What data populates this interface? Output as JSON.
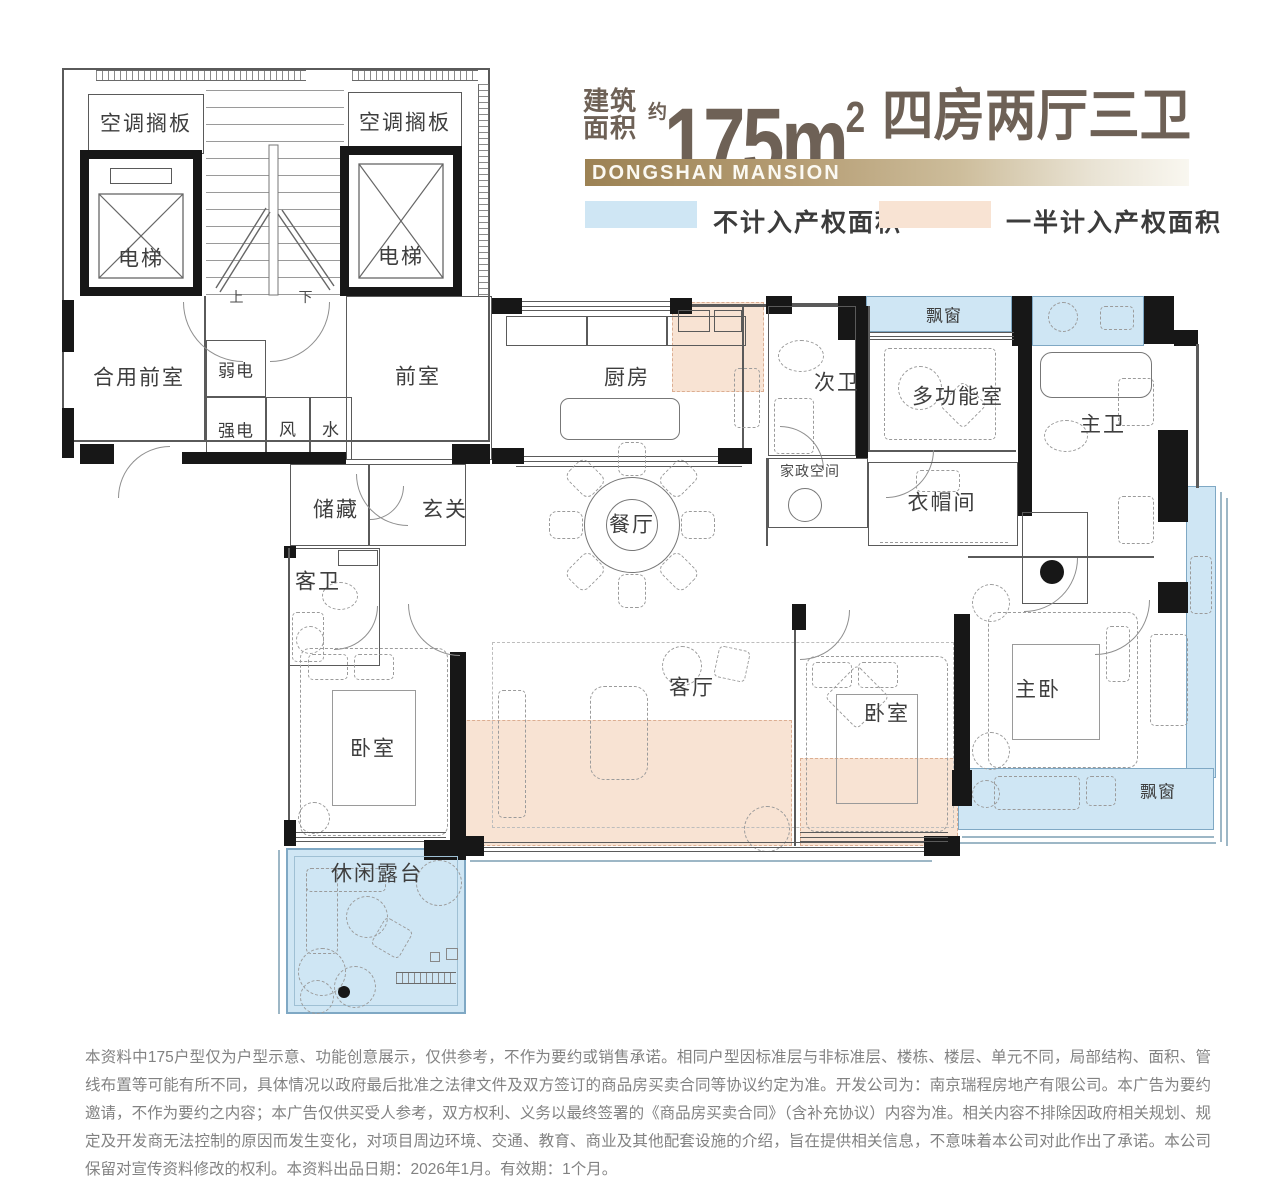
{
  "header": {
    "area_label_line1": "建筑",
    "area_label_line2": "面积",
    "area_approx": "约",
    "area_value": "175m",
    "area_exponent": "2",
    "layout_text": "四房两厅三卫",
    "brand": "DONGSHAN MANSION",
    "legend": {
      "not_counted": {
        "label": "不计入产权面积",
        "color": "#cfe6f4"
      },
      "half_counted": {
        "label": "一半计入产权面积",
        "color": "#f8e3d3"
      }
    }
  },
  "rooms": {
    "ac_shelf_left": "空调搁板",
    "ac_shelf_right": "空调搁板",
    "elevator_left": "电梯",
    "elevator_right": "电梯",
    "stairs_up": "上",
    "stairs_down": "下",
    "shared_front_room": "合用前室",
    "weak_electric": "弱电",
    "strong_electric": "强电",
    "vent_shaft": "风",
    "water_shaft": "水",
    "front_room": "前室",
    "storage": "储藏",
    "entryway": "玄关",
    "kitchen": "厨房",
    "second_bath": "次卫",
    "housekeeping": "家政空间",
    "multifunction_room": "多功能室",
    "bay_window_top": "飘窗",
    "master_bath": "主卫",
    "cloakroom": "衣帽间",
    "dining_room": "餐厅",
    "guest_bath": "客卫",
    "living_room": "客厅",
    "bedroom_left": "卧室",
    "bedroom_right": "卧室",
    "master_bedroom": "主卧",
    "bay_window_bottom": "飘窗",
    "leisure_terrace": "休闲露台"
  },
  "colors": {
    "title_brown": "#6e6156",
    "brand_gold": "#9c8254",
    "not_counted_blue": "#cfe6f4",
    "half_counted_peach": "#f8e3d3",
    "wall_black": "#171717"
  },
  "disclaimer": "本资料中175户型仅为户型示意、功能创意展示，仅供参考，不作为要约或销售承诺。相同户型因标准层与非标准层、楼栋、楼层、单元不同，局部结构、面积、管线布置等可能有所不同，具体情况以政府最后批准之法律文件及双方签订的商品房买卖合同等协议约定为准。开发公司为：南京瑞程房地产有限公司。本广告为要约邀请，不作为要约之内容；本广告仅供买受人参考，双方权利、义务以最终签署的《商品房买卖合同》（含补充协议）内容为准。相关内容不排除因政府相关规划、规定及开发商无法控制的原因而发生变化，对项目周边环境、交通、教育、商业及其他配套设施的介绍，旨在提供相关信息，不意味着本公司对此作出了承诺。本公司保留对宣传资料修改的权利。本资料出品日期：2026年1月。有效期：1个月。"
}
